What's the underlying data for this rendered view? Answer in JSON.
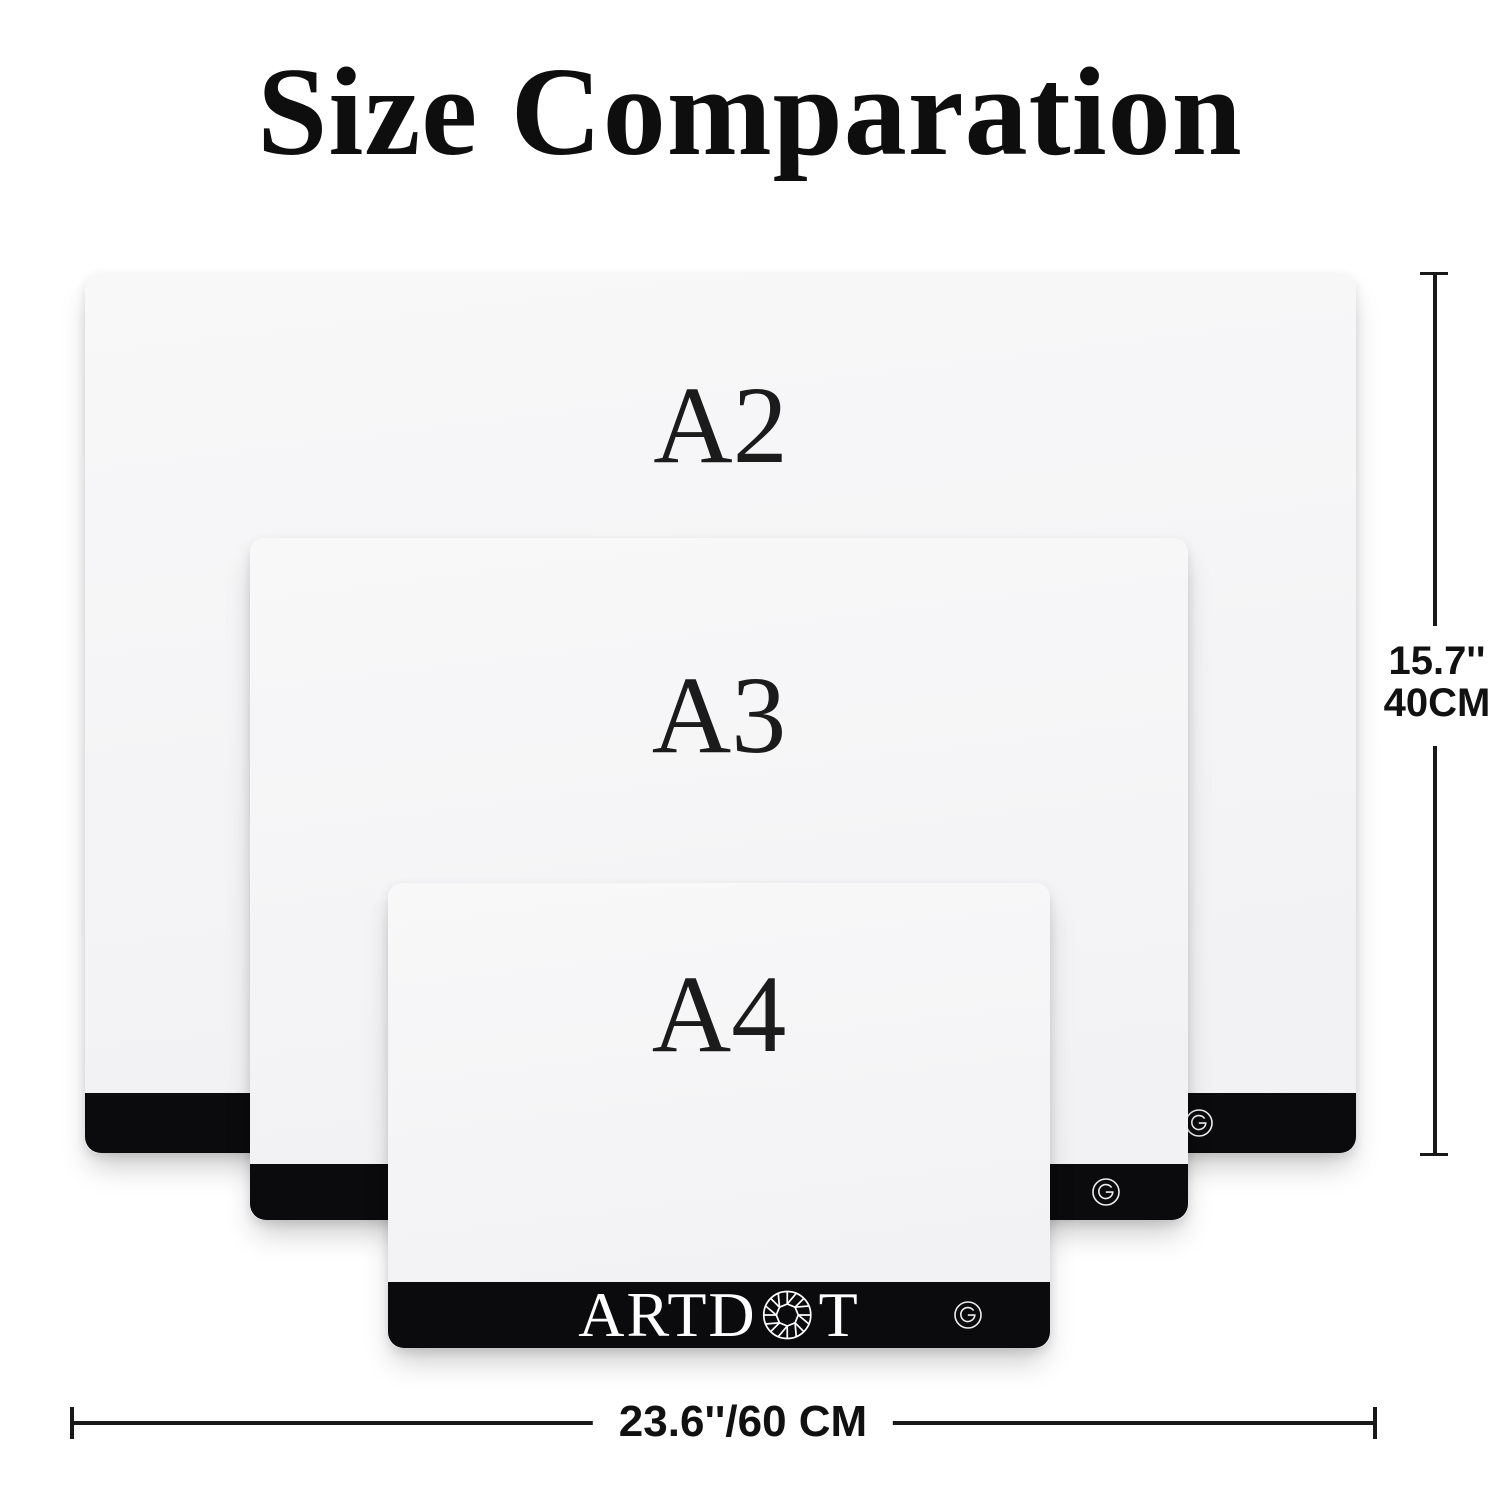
{
  "title": "Size Comparation",
  "pads": [
    {
      "label": "A2"
    },
    {
      "label": "A3"
    },
    {
      "label": "A4"
    }
  ],
  "brand": {
    "logo_left": "ARTD",
    "logo_right": "T",
    "gem_icon": "diamond-gem-icon",
    "touch_button_icon": "g-touch-button-icon"
  },
  "dimensions": {
    "height_inches": "15.7''",
    "height_cm": "40CM",
    "width_label": "23.6''/60 CM"
  },
  "colors": {
    "background": "#ffffff",
    "pad_surface": "#f6f6f7",
    "bottom_bar": "#0b0b0d",
    "text": "#161616",
    "logo_text": "#ffffff",
    "dimension_line": "#191919"
  }
}
